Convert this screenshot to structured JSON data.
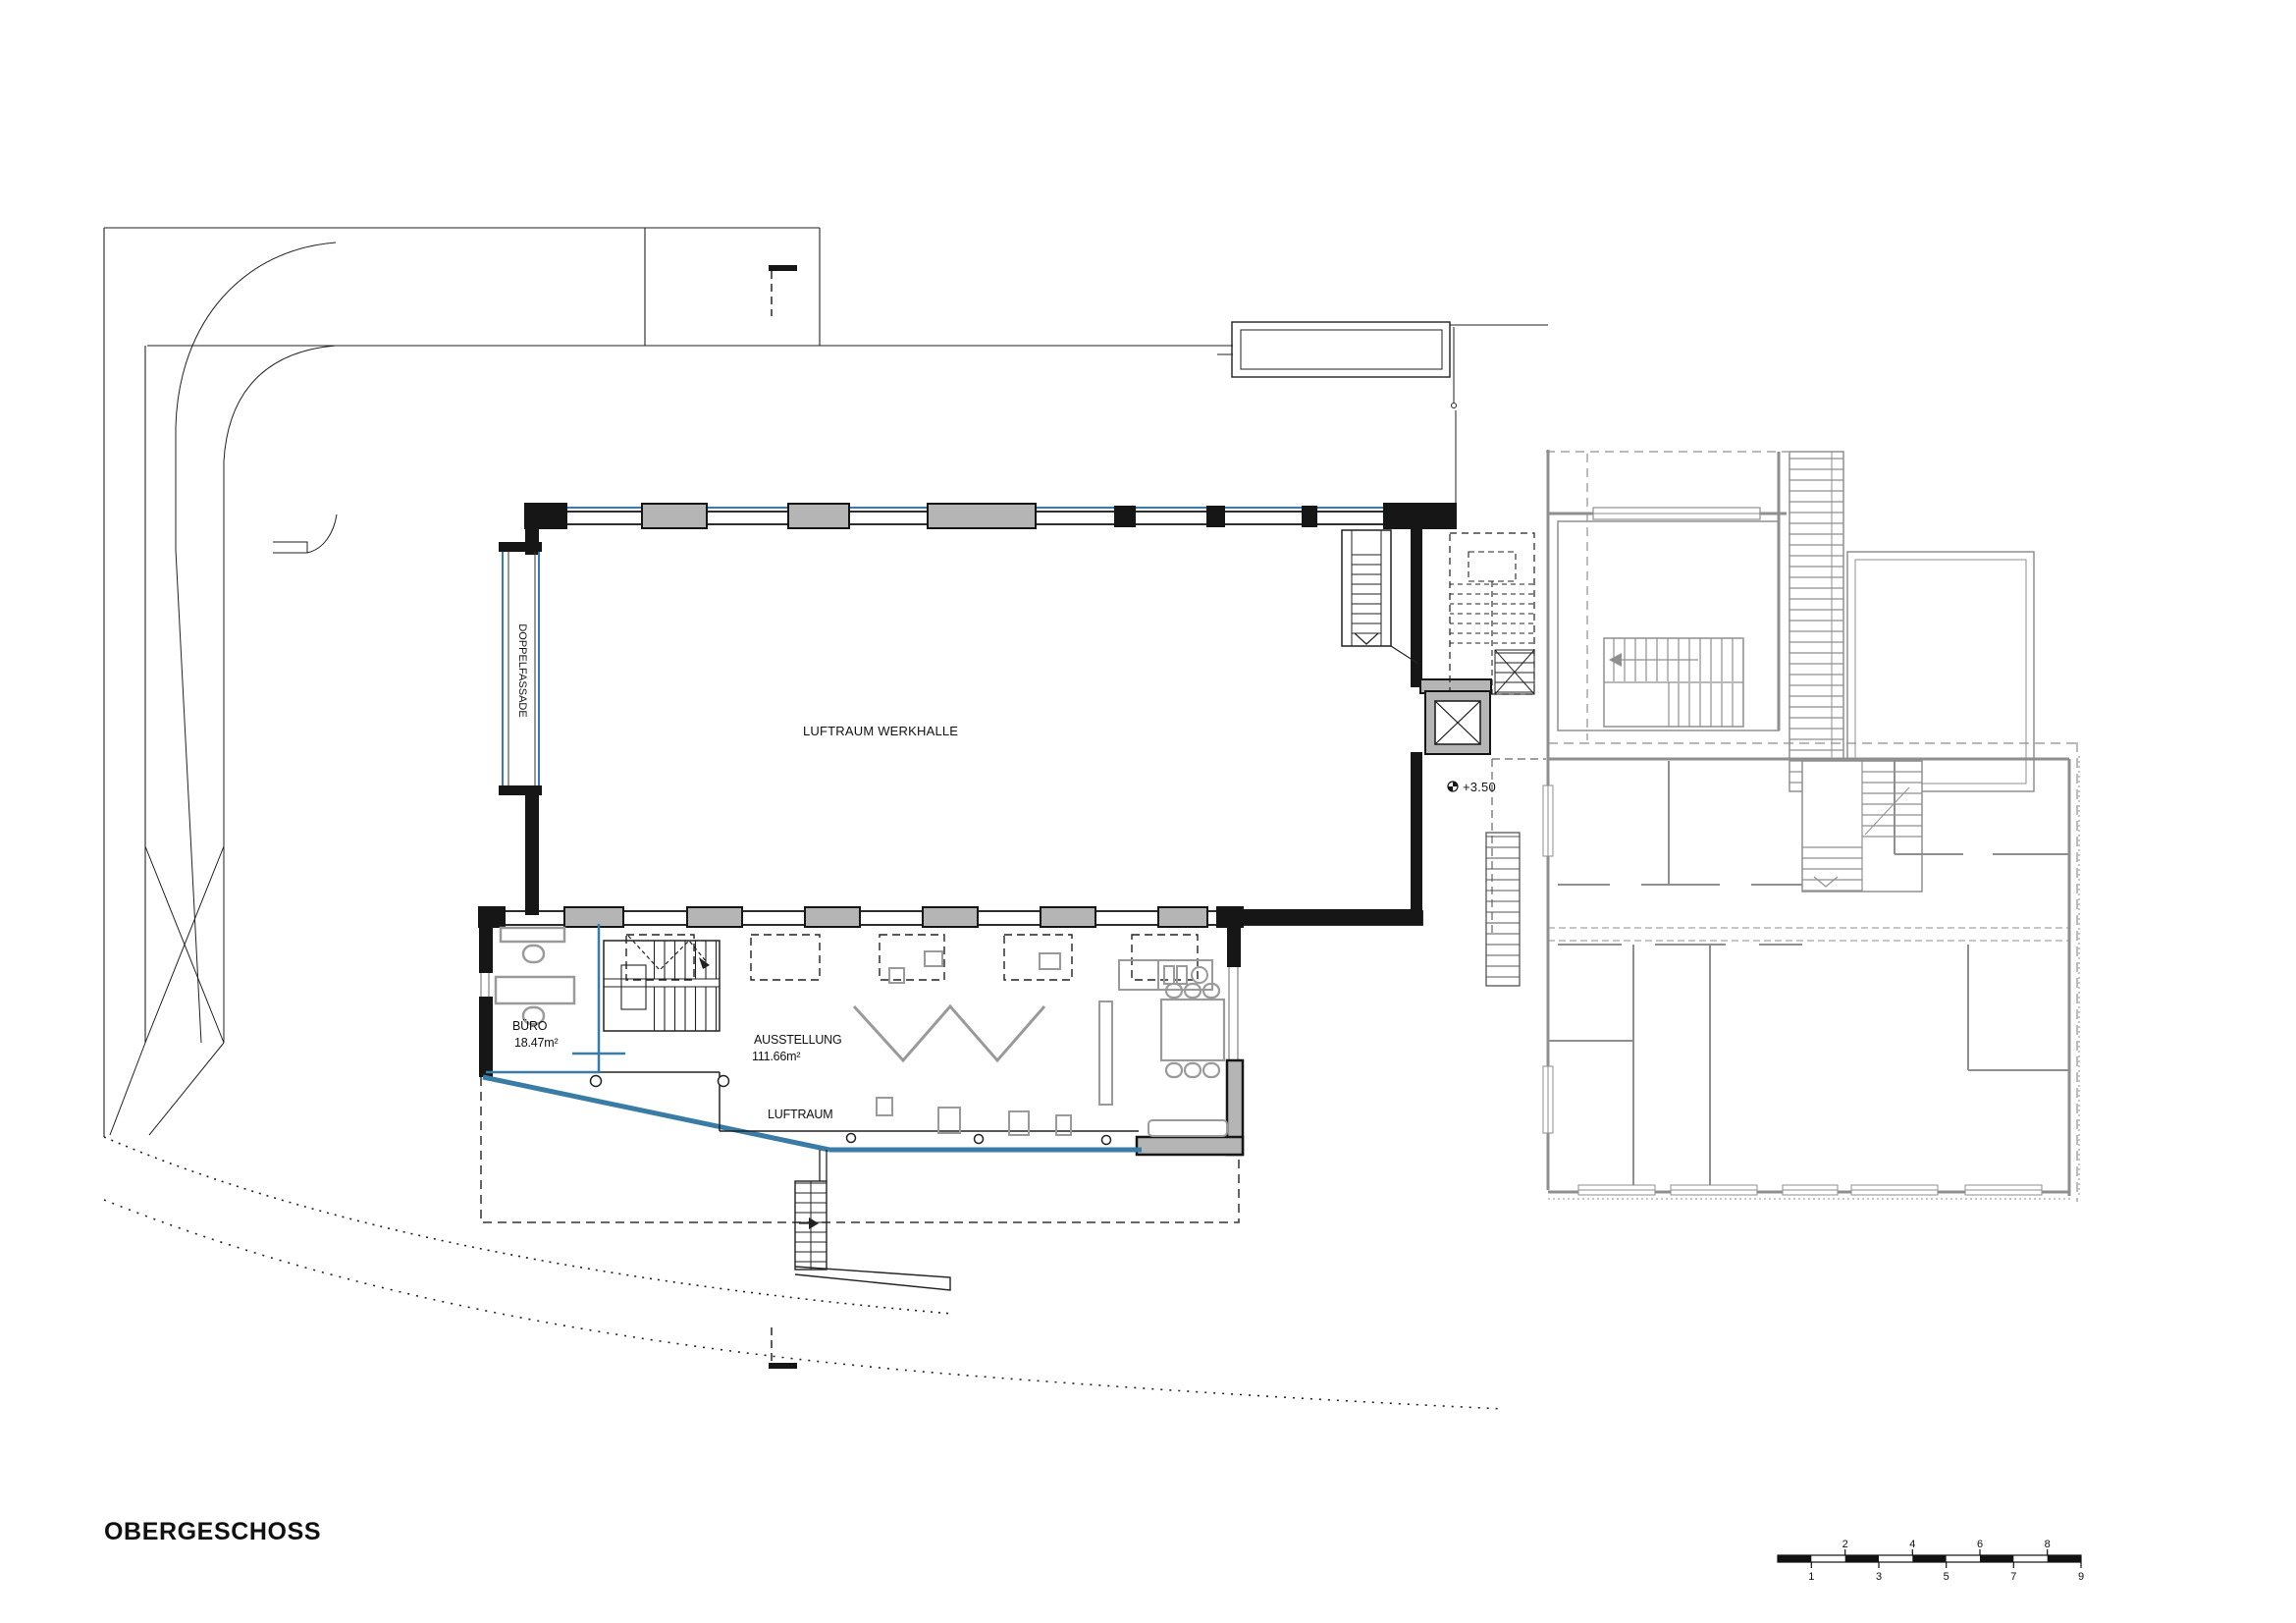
{
  "title": "OBERGESCHOSS",
  "plan": {
    "werkhalle_label": "LUFTRAUM WERKHALLE",
    "doppelfassade_label": "DOPPELFASSADE",
    "buero": {
      "label": "BÜRO",
      "area": "18.47m²"
    },
    "ausstellung": {
      "label": "AUSSTELLUNG",
      "area": "111.66m²"
    },
    "luftraum_label": "LUFTRAUM",
    "elevation_marker": "+3.50"
  },
  "scalebar": {
    "labels": [
      "1",
      "2",
      "3",
      "4",
      "5",
      "6",
      "7",
      "8",
      "9"
    ]
  },
  "colors": {
    "glass_blue": "#3a7ca5",
    "wall_black": "#161616",
    "pier_gray": "#b5b5b5",
    "furniture_gray": "#9a9a9a",
    "existing_gray": "#8f8f8f"
  }
}
